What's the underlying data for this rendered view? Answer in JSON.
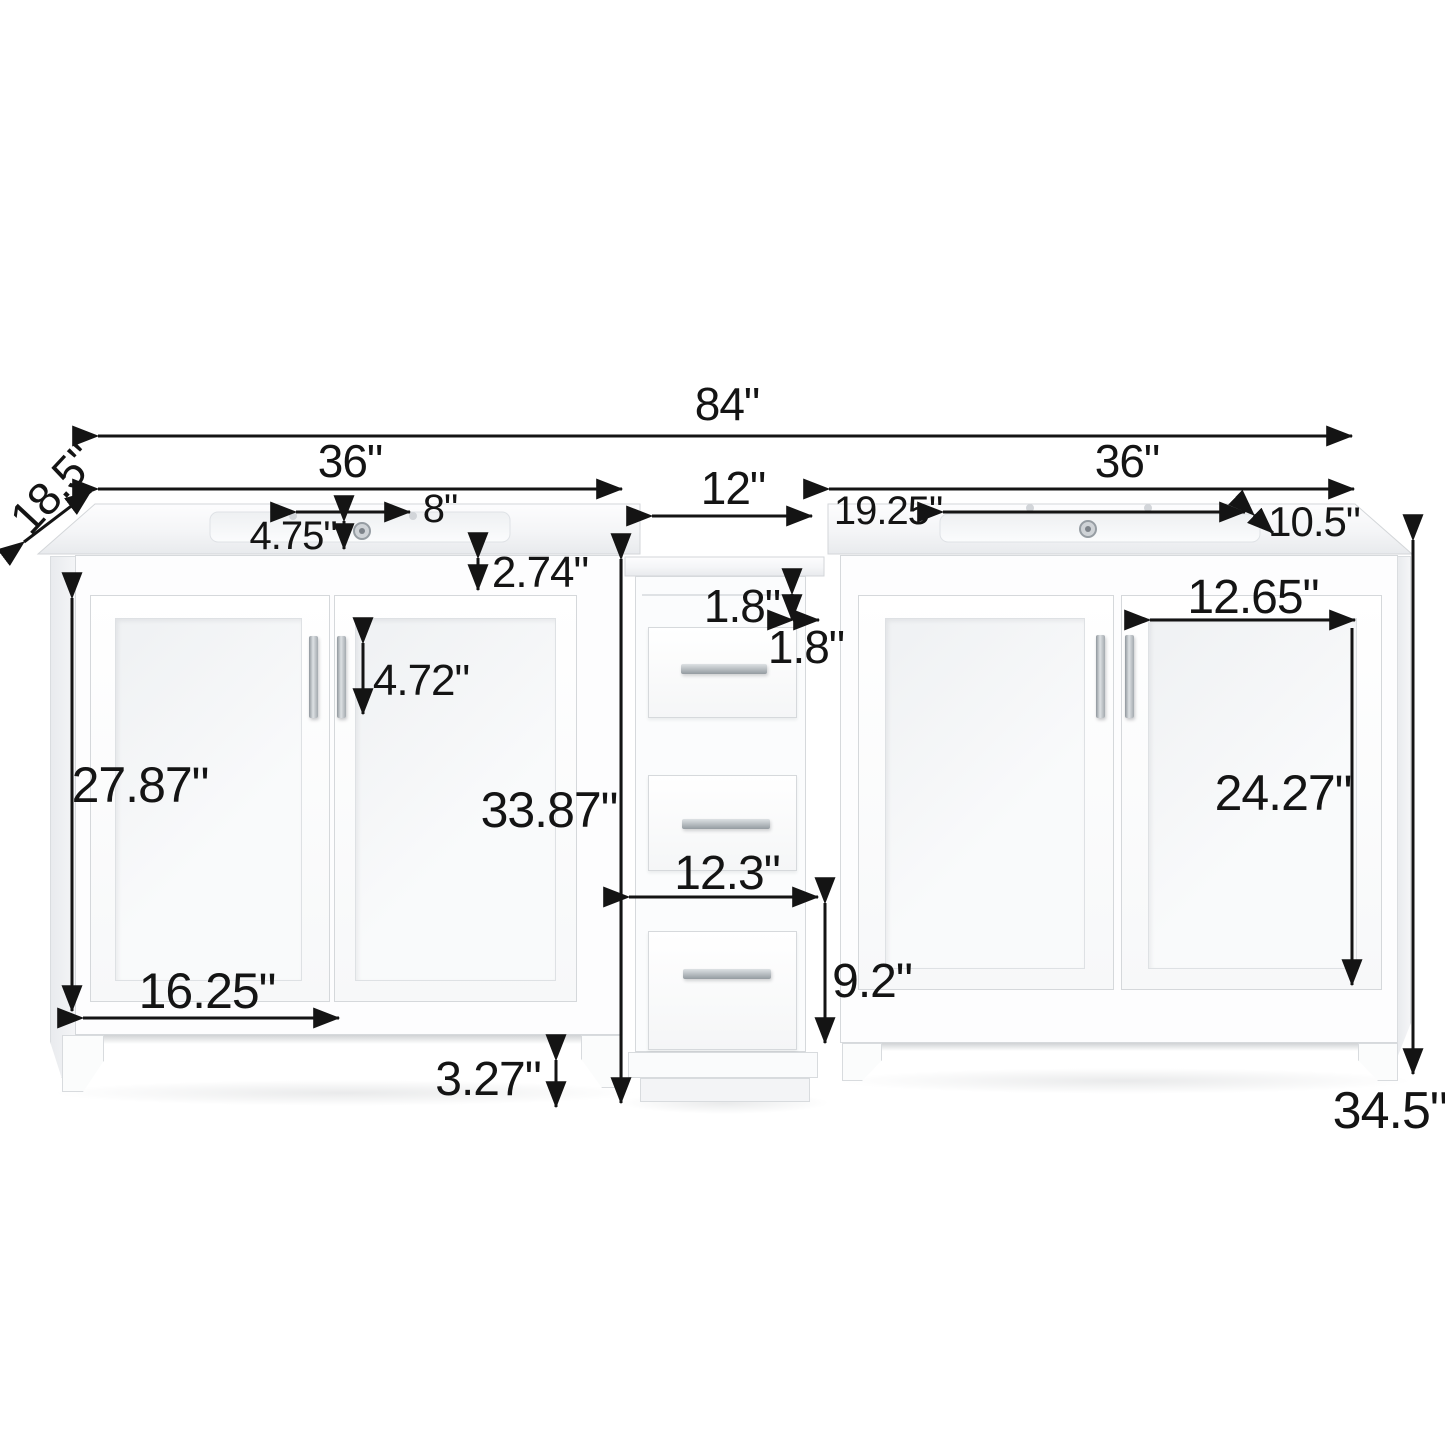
{
  "diagram": {
    "kind": "product-dimension-diagram",
    "product": "84 inch double sink bathroom vanity with middle drawer tower",
    "unit": "inch",
    "line_color": "#141414",
    "furniture_color": "#ffffff",
    "hardware_color": "#a7adb2",
    "dims": {
      "overall_width": "84\"",
      "left_cabinet_width": "36\"",
      "right_cabinet_width": "36\"",
      "middle_tower_width": "12\"",
      "counter_depth": "18.5\"",
      "faucet_hole_spread": "8\"",
      "sink_back_offset": "4.75\"",
      "counter_to_door_gap": "2.74\"",
      "sink_side_offset": "19.25\"",
      "sink_bowl_depth": "10.5\"",
      "tower_top_rail": "1.8\"",
      "tower_side_rail": "1.8\"",
      "handle_length": "4.72\"",
      "left_door_height": "27.87\"",
      "middle_tower_height": "33.87\"",
      "left_door_width": "16.25\"",
      "toe_kick_height": "3.27\"",
      "tower_drawer_width": "12.3\"",
      "bottom_drawer_height": "9.2\"",
      "right_door_panel_width": "12.65\"",
      "right_door_height": "24.27\"",
      "overall_height": "34.5\""
    }
  }
}
